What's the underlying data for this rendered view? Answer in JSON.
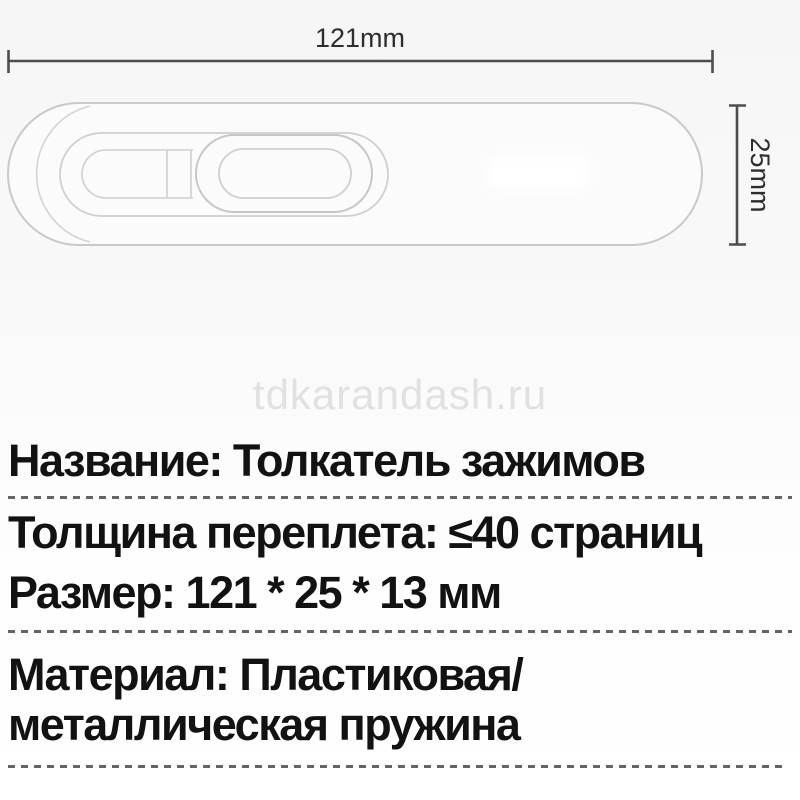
{
  "diagram": {
    "width_label": "121mm",
    "height_label": "25mm",
    "subject": "clip-pusher-technical-drawing"
  },
  "watermark": {
    "text": "tdkarandash.ru"
  },
  "specs": {
    "name_row": "Название: Толкатель зажимов",
    "thickness_row": "Толщина переплета: ≤40 страниц",
    "size_row": "Размер: 121 * 25 * 13 мм",
    "material_row_line1": "Материал: Пластиковая/",
    "material_row_line2": "металлическая пружина"
  },
  "colors": {
    "spec_text": "#121212",
    "dimension_line": "#4d4d4d",
    "dimension_text": "#2e2e2e",
    "product_outline": "#c9c9c9",
    "watermark_text": "#e1e1e1",
    "dashed_divider": "#646464",
    "background": "#f8f8f8"
  }
}
